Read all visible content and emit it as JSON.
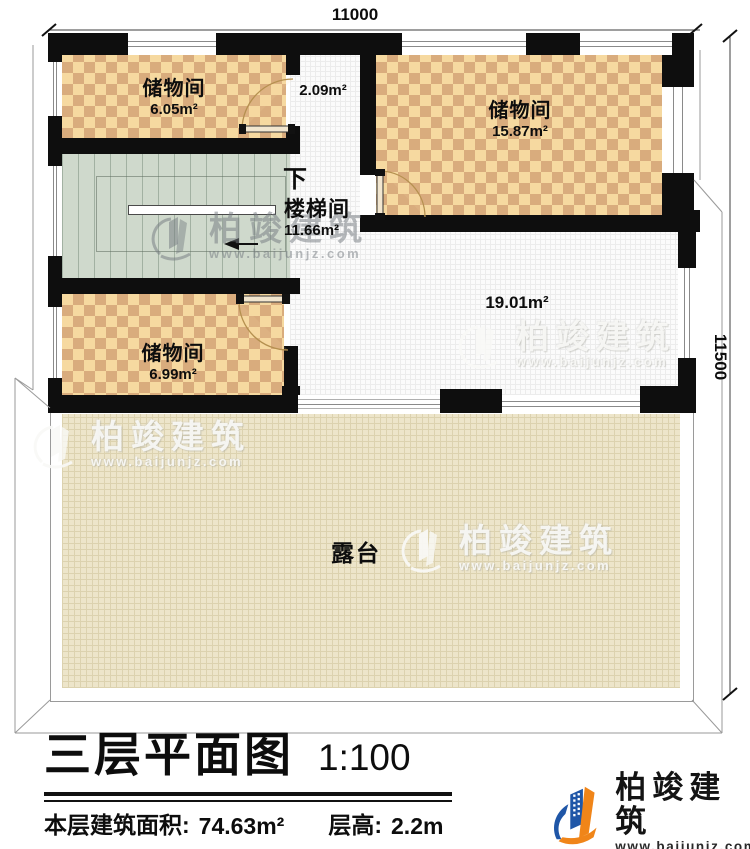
{
  "plan": {
    "dim_top": "11000",
    "dim_right": "11500",
    "rooms": {
      "storage_a": {
        "name": "储物间",
        "area": "6.05m²"
      },
      "hall_small": {
        "area": "2.09m²"
      },
      "storage_b": {
        "name": "储物间",
        "area": "15.87m²"
      },
      "stair": {
        "down": "下",
        "name": "楼梯间",
        "area": "11.66m²"
      },
      "storage_c": {
        "name": "储物间",
        "area": "6.99m²"
      },
      "hall": {
        "area": "19.01m²"
      },
      "terrace": {
        "name": "露台"
      }
    }
  },
  "watermark": {
    "brand": "柏竣建筑",
    "site": "www.baijunjz.com"
  },
  "titleblock": {
    "title": "三层平面图",
    "scale": "1:100",
    "area_label": "本层建筑面积:",
    "area_value": "74.63m²",
    "height_label": "层高:",
    "height_value": "2.2m"
  },
  "brand": {
    "name": "柏竣建筑",
    "site": "www.baijunjz.com"
  },
  "colors": {
    "wall": "#0e0e0e",
    "checker_light": "#f6d9a0",
    "checker_dark": "#d9ac7d",
    "stair_floor": "#cfd9cc",
    "terrace": "#ede5ca",
    "brand_blue": "#1f56a7",
    "brand_orange": "#f08519"
  }
}
